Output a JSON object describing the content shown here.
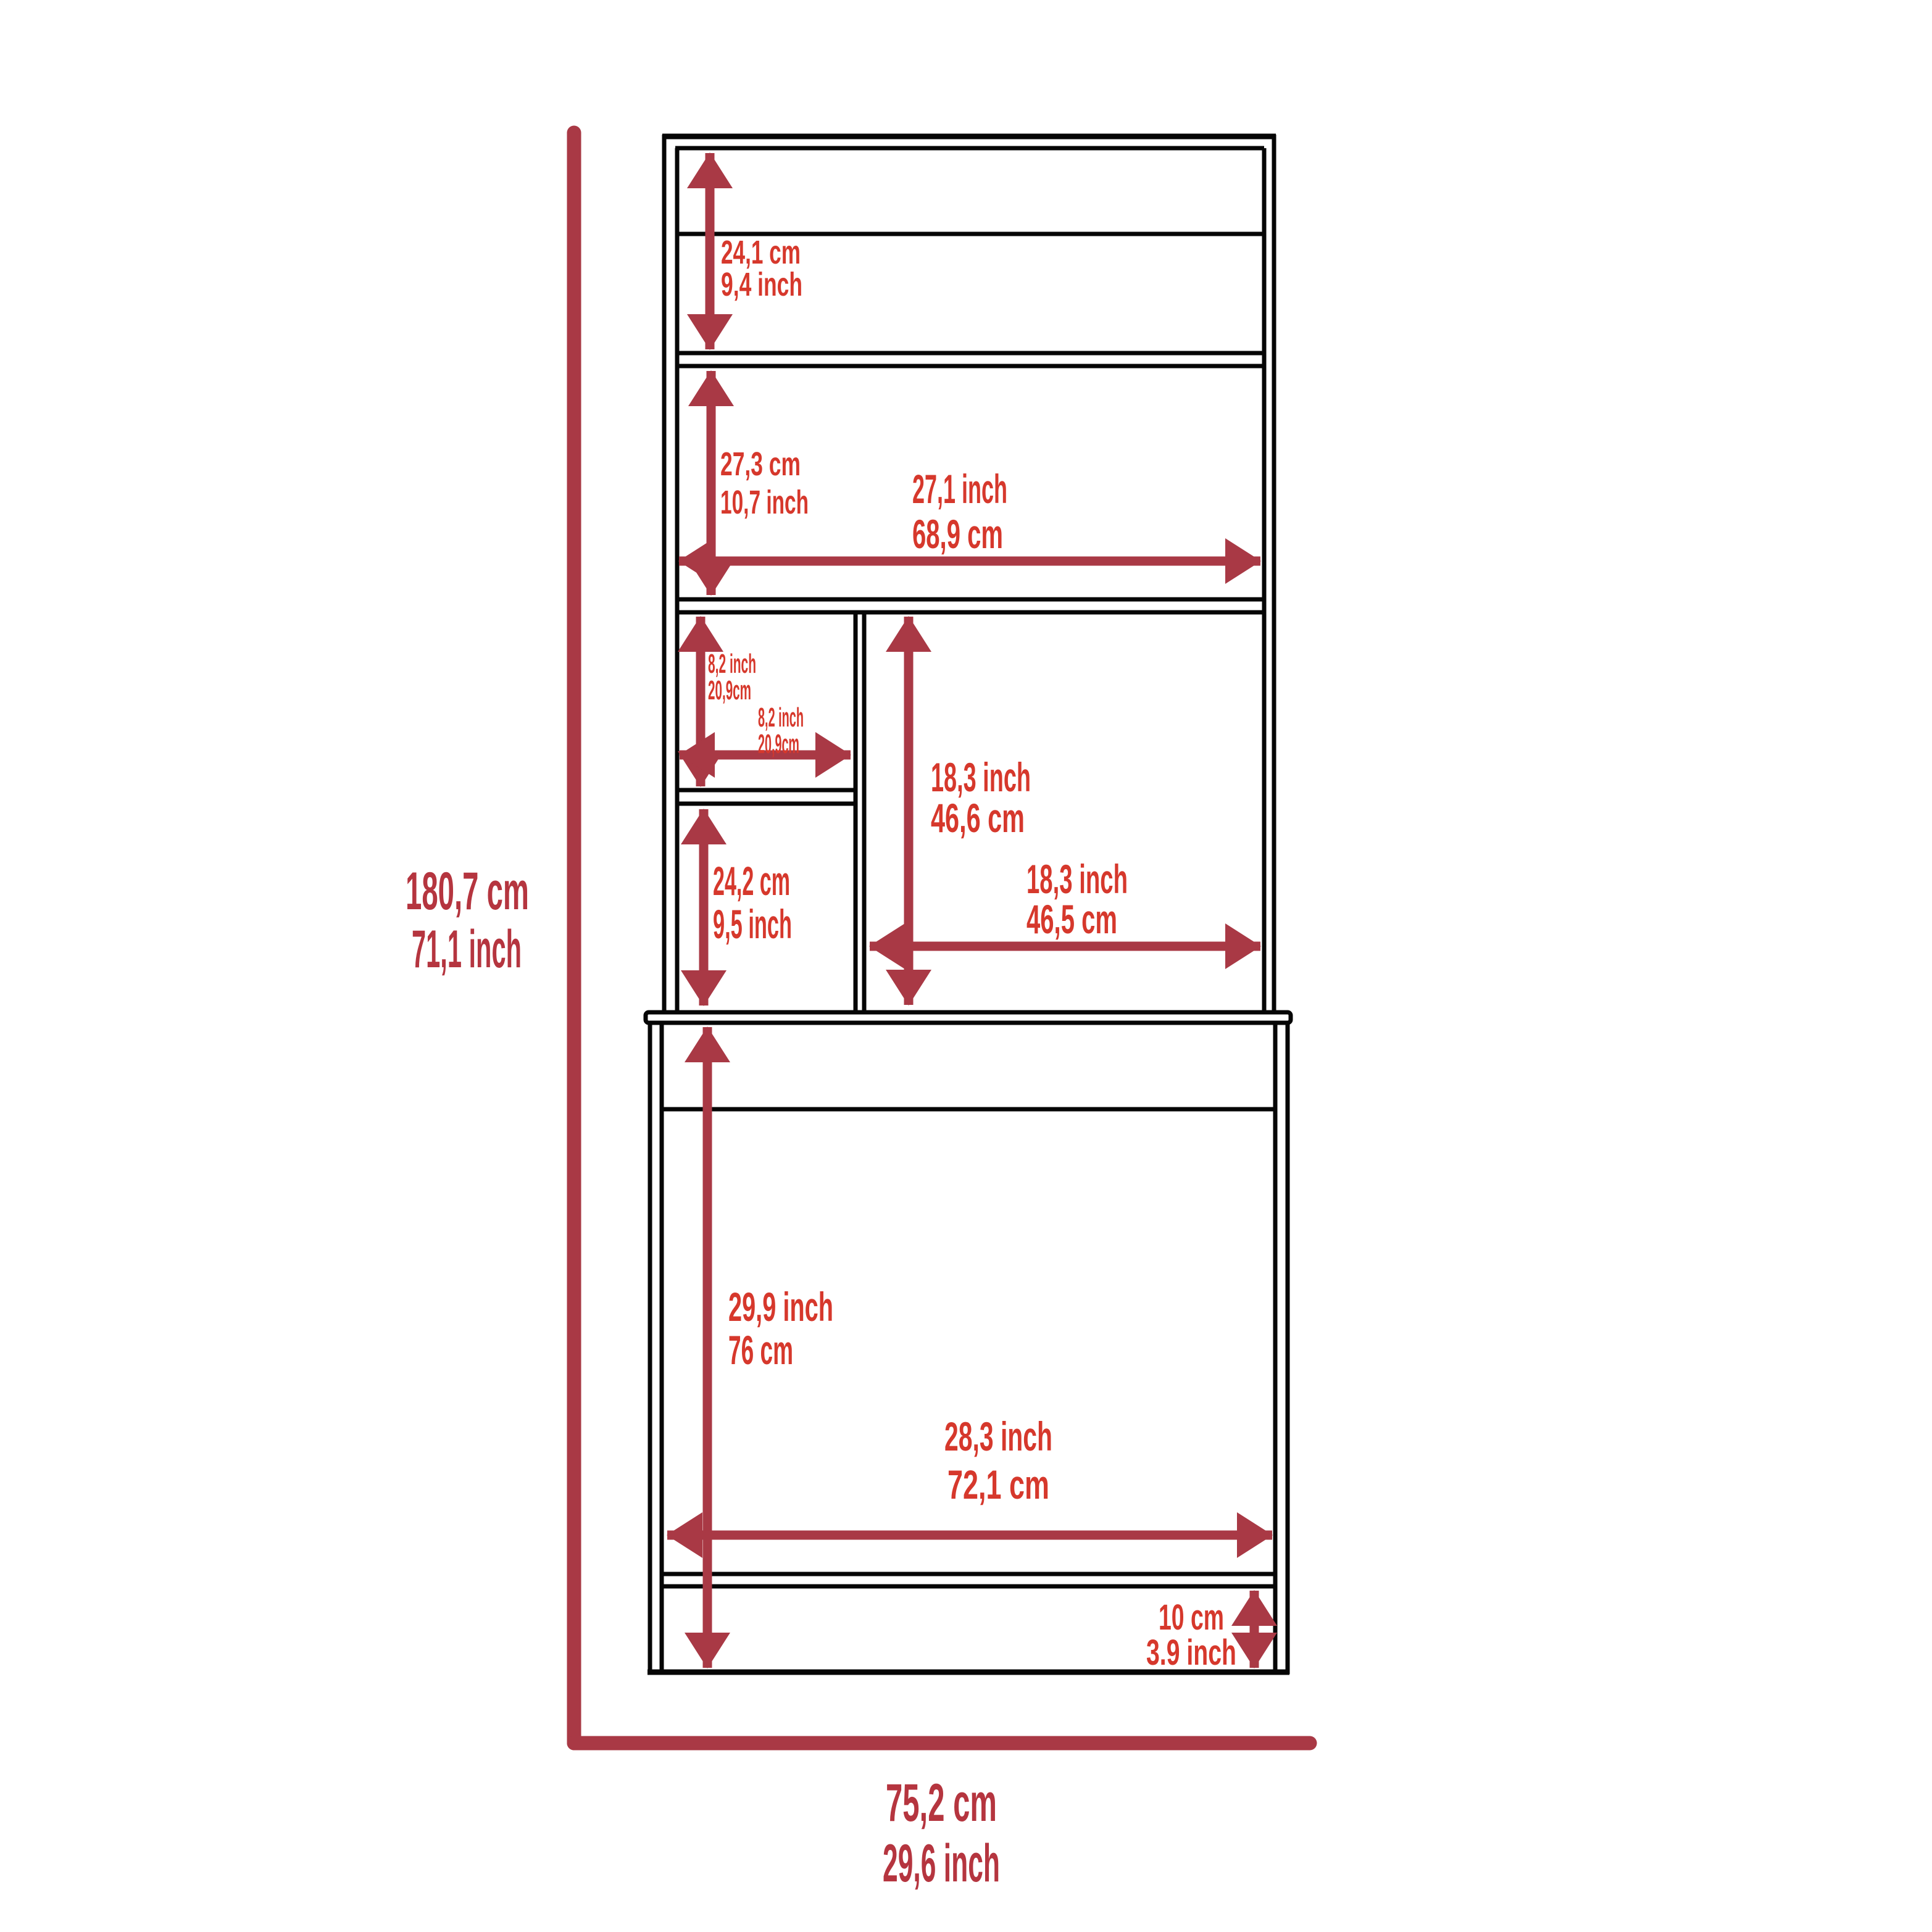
{
  "colors": {
    "label_inner_red": "#d6382c",
    "label_outer_red": "#b5353f",
    "dimension_red": "#a93945",
    "outline_black": "#060606",
    "background": "#ffffff"
  },
  "dimensions": {
    "overall_height": {
      "primary": "180,7 cm",
      "secondary": "71,1 inch"
    },
    "overall_width": {
      "primary": "75,2 cm",
      "secondary": "29,6 inch"
    },
    "top_shelf_height": {
      "primary": "24,1 cm",
      "secondary": "9,4 inch"
    },
    "middle_shelf_height": {
      "primary": "27,3 cm",
      "secondary": "10,7 inch"
    },
    "hutch_interior_width": {
      "primary": "27,1 inch",
      "secondary": "68,9 cm"
    },
    "cubby_height": {
      "primary": "8,2 inch",
      "secondary": "20,9cm"
    },
    "cubby_width": {
      "primary": "8,2 inch",
      "secondary": "20,9cm"
    },
    "lower_cubby_height": {
      "primary": "24,2 cm",
      "secondary": "9,5 inch"
    },
    "right_compartment_height": {
      "primary": "18,3 inch",
      "secondary": "46,6 cm"
    },
    "right_compartment_width": {
      "primary": "18,3 inch",
      "secondary": "46,5 cm"
    },
    "base_cabinet_height": {
      "primary": "29,9 inch",
      "secondary": "76 cm"
    },
    "base_interior_width": {
      "primary": "28,3 inch",
      "secondary": "72,1 cm"
    },
    "base_plinth_height": {
      "primary": "10 cm",
      "secondary": "3.9 inch"
    }
  }
}
